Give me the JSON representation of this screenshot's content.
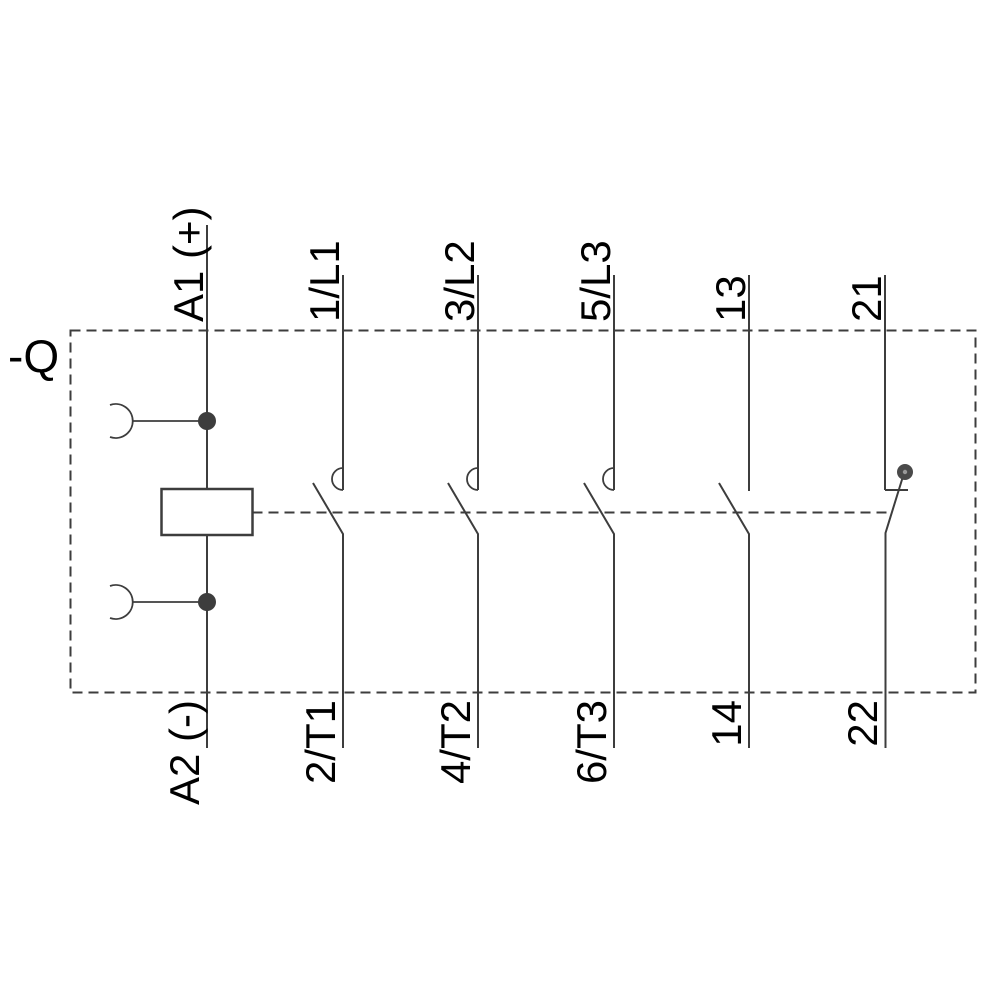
{
  "device_label": "-Q",
  "coil": {
    "top_terminal": "A1 (+)",
    "bottom_terminal": "A2 (-)"
  },
  "main_contacts": [
    {
      "top_terminal": "1/L1",
      "bottom_terminal": "2/T1"
    },
    {
      "top_terminal": "3/L2",
      "bottom_terminal": "4/T2"
    },
    {
      "top_terminal": "5/L3",
      "bottom_terminal": "6/T3"
    }
  ],
  "aux_contacts": [
    {
      "top_terminal": "13",
      "bottom_terminal": "14",
      "contact_type": "NO"
    },
    {
      "top_terminal": "21",
      "bottom_terminal": "22",
      "contact_type": "NC"
    }
  ],
  "colors": {
    "line": "#3d3d3d",
    "text": "#000000",
    "background": "#ffffff",
    "pivot_fill": "#4a4a4a",
    "pivot_center": "#9a9a9a"
  }
}
